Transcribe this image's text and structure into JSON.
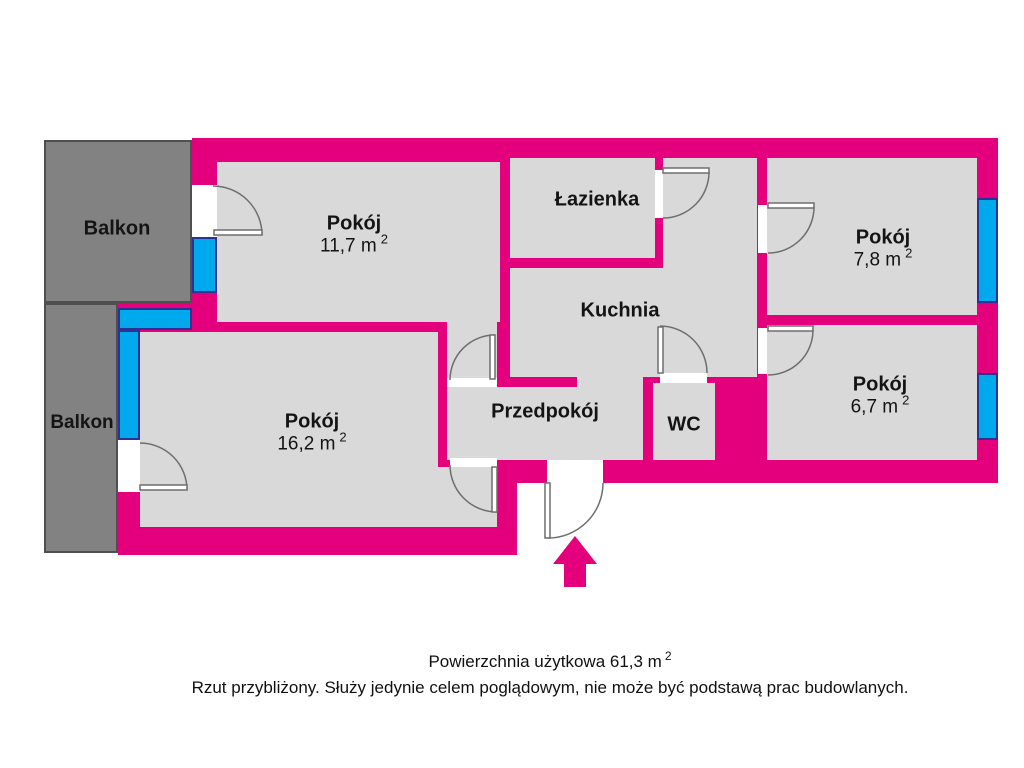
{
  "colors": {
    "wall": "#e4007c",
    "window": "#00a8ec",
    "window_edge": "#2e3192",
    "room_fill": "#d9d9d9",
    "balcony_fill": "#828282",
    "door_stroke": "#6e6e6e",
    "text": "#141414"
  },
  "rooms": {
    "pokoj_117": {
      "name": "Pokój",
      "area": "11,7 m",
      "sup": "2"
    },
    "pokoj_78": {
      "name": "Pokój",
      "area": "7,8 m",
      "sup": "2"
    },
    "pokoj_67": {
      "name": "Pokój",
      "area": "6,7 m",
      "sup": "2"
    },
    "pokoj_162": {
      "name": "Pokój",
      "area": "16,2 m",
      "sup": "2"
    },
    "lazienka": {
      "name": "Łazienka"
    },
    "kuchnia": {
      "name": "Kuchnia"
    },
    "przedpokoj": {
      "name": "Przedpokój"
    },
    "wc": {
      "name": "WC"
    },
    "balkon_top": {
      "name": "Balkon"
    },
    "balkon_bottom": {
      "name": "Balkon"
    }
  },
  "caption": {
    "line1": "Powierzchnia użytkowa 61,3 m",
    "line1_sup": "2",
    "line2": "Rzut przybliżony. Służy jedynie celem poglądowym, nie może być podstawą prac budowlanych."
  }
}
